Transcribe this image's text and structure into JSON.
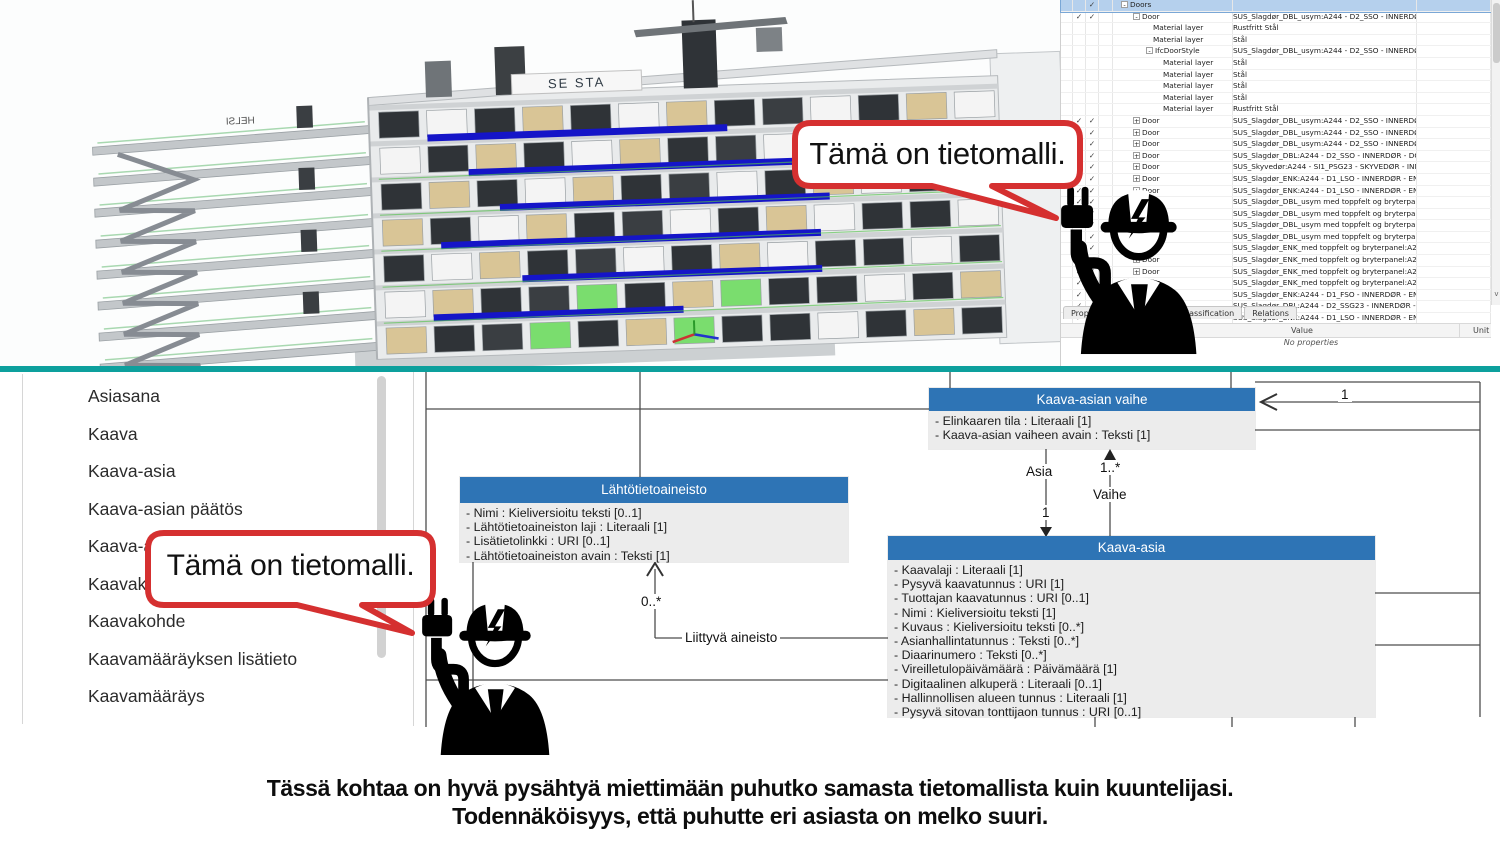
{
  "colors": {
    "accent_blue": "#2e74b5",
    "teal": "#0da09d",
    "bubble_red": "#d53030",
    "selection_blue": "#b5d0ed"
  },
  "bubble": {
    "text": "Tämä on tietomalli."
  },
  "bim_view": {
    "roof_sign": "HELSI",
    "top_sign": "SE STA"
  },
  "top_panel": {
    "tabs": [
      "Properties",
      "Location",
      "Classification",
      "Relations"
    ],
    "value_header": "Value",
    "unit_header": "Unit",
    "empty_text": "No properties",
    "rows": [
      {
        "name": "Doors",
        "value": "",
        "glyph": "-",
        "pad": 8,
        "checks": [
          2
        ],
        "selected": true
      },
      {
        "name": "Door",
        "value": "SUS_Slagdør_DBL_usym:A244 - D2_SSO - INNERDØR  - DO...",
        "glyph": "-",
        "pad": 20,
        "checks": [
          1,
          2
        ]
      },
      {
        "name": "Material layer",
        "value": "Rustfritt Stål",
        "pad": 40,
        "checks": []
      },
      {
        "name": "Material layer",
        "value": "Stål",
        "pad": 40,
        "checks": []
      },
      {
        "name": "IfcDoorStyle",
        "value": "SUS_Slagdør_DBL_usym:A244 - D2_SSO - INNERDØR  - DO...",
        "glyph": "-",
        "pad": 33,
        "checks": []
      },
      {
        "name": "Material layer",
        "value": "Stål",
        "pad": 50,
        "checks": []
      },
      {
        "name": "Material layer",
        "value": "Stål",
        "pad": 50,
        "checks": []
      },
      {
        "name": "Material layer",
        "value": "Stål",
        "pad": 50,
        "checks": []
      },
      {
        "name": "Material layer",
        "value": "Stål",
        "pad": 50,
        "checks": []
      },
      {
        "name": "Material layer",
        "value": "Rustfritt Stål",
        "pad": 50,
        "checks": []
      },
      {
        "name": "Door",
        "value": "SUS_Slagdør_DBL_usym:A244 - D2_SSO - INNERDØR  - DO...",
        "glyph": "+",
        "pad": 20,
        "checks": [
          1,
          2
        ]
      },
      {
        "name": "Door",
        "value": "SUS_Slagdør_DBL_usym:A244 - D2_SSO - INNERDØR  - DO...",
        "glyph": "+",
        "pad": 20,
        "checks": [
          1,
          2
        ]
      },
      {
        "name": "Door",
        "value": "SUS_Slagdør_DBL_usym:A244 - D2_SSO - INNERDØR  - DO...",
        "glyph": "+",
        "pad": 20,
        "checks": [
          1,
          2
        ]
      },
      {
        "name": "Door",
        "value": "SUS_Slagdør_DBL:A244 - D2_SSO - INNERDØR - DOBBEL - ...",
        "glyph": "+",
        "pad": 20,
        "checks": [
          1,
          2
        ]
      },
      {
        "name": "Door",
        "value": "SUS_Skyvedør:A244 - SI1_PSG23 - SKYVEDØR - INNERDØR...",
        "glyph": "+",
        "pad": 20,
        "checks": [
          1,
          2
        ]
      },
      {
        "name": "Door",
        "value": "SUS_Slagdør_ENK:A244 - D1_LSO - INNERDØR  - ENKEL - 1...",
        "glyph": "+",
        "pad": 20,
        "checks": [
          1,
          2
        ]
      },
      {
        "name": "Door",
        "value": "SUS_Slagdør_ENK:A244 - D1_LSO - INNERDØR  - ENKEL - 1...",
        "glyph": "+",
        "pad": 20,
        "checks": [
          1,
          2
        ]
      },
      {
        "name": "Door",
        "value": "SUS_Slagdør_DBL_usym med toppfelt og bryterpanel:A244 ...",
        "glyph": "+",
        "pad": 20,
        "checks": [
          1,
          2
        ]
      },
      {
        "name": "Door",
        "value": "SUS_Slagdør_DBL_usym med toppfelt og bryterpanel:A244 ...",
        "glyph": "+",
        "pad": 20,
        "checks": [
          1,
          2
        ]
      },
      {
        "name": "Door",
        "value": "SUS_Slagdør_DBL_usym med toppfelt og bryterpanel:A244 ...",
        "glyph": "+",
        "pad": 20,
        "checks": [
          1,
          2
        ]
      },
      {
        "name": "Door",
        "value": "SUS_Slagdør_DBL_usym med toppfelt og bryterpanel:A244 ...",
        "glyph": "+",
        "pad": 20,
        "checks": [
          1,
          2
        ]
      },
      {
        "name": "Door",
        "value": "SUS_Slagdør_ENK_med toppfelt og bryterpanel:A244 - D1_...",
        "glyph": "+",
        "pad": 20,
        "checks": [
          1,
          2
        ]
      },
      {
        "name": "Door",
        "value": "SUS_Slagdør_ENK_med toppfelt og bryterpanel:A244 - D1_...",
        "glyph": "+",
        "pad": 20,
        "checks": [
          1,
          2
        ]
      },
      {
        "name": "Door",
        "value": "SUS_Slagdør_ENK_med toppfelt og bryterpanel:A244 - D1_...",
        "glyph": "+",
        "pad": 20,
        "checks": [
          1,
          2
        ]
      },
      {
        "name": "Door",
        "value": "SUS_Slagdør_ENK_med toppfelt og bryterpanel:A244 - D1_...",
        "glyph": "+",
        "pad": 20,
        "checks": [
          1,
          2
        ]
      },
      {
        "name": "Door",
        "value": "SUS_Slagdør_ENK:A244 - D1_FSO - INNERDØR  - ENKEL - B...",
        "glyph": "+",
        "pad": 20,
        "checks": [
          1,
          2
        ]
      },
      {
        "name": "Door",
        "value": "SUS_Slagdør_DBL:A244 - D2_SSG23 - INNERDØR - DOBBEL...",
        "glyph": "+",
        "pad": 20,
        "checks": [
          1,
          2
        ]
      },
      {
        "name": "Door",
        "value": "SUS_Slagdør_ENK:A244 - D1_LSO - INNERDØR - ENKEL - 1...",
        "glyph": "+",
        "pad": 20,
        "checks": [
          1,
          2
        ]
      }
    ]
  },
  "sidebar": {
    "items": [
      "Asiasana",
      "Kaava",
      "Kaava-asia",
      "Kaava-asian päätös",
      "Kaava-asian vaihe",
      "Kaavakartta",
      "Kaavakohde",
      "Kaavamääräyksen lisätieto",
      "Kaavamääräys"
    ]
  },
  "uml": {
    "vaihe": {
      "title": "Kaava-asian vaihe",
      "attrs": [
        "- Elinkaaren tila : Literaali [1]",
        "- Kaava-asian vaiheen avain : Teksti [1]"
      ]
    },
    "lahtotieto": {
      "title": "Lähtötietoaineisto",
      "attrs": [
        "- Nimi : Kieliversioitu teksti [0..1]",
        "- Lähtötietoaineiston laji : Literaali [1]",
        "- Lisätietolinkki : URI [0..1]",
        "- Lähtötietoaineiston avain : Teksti [1]"
      ]
    },
    "kaava_asia": {
      "title": "Kaava-asia",
      "attrs": [
        "- Kaavalaji : Literaali [1]",
        "- Pysyvä kaavatunnus : URI [1]",
        "- Tuottajan kaavatunnus : URI [0..1]",
        "- Nimi : Kieliversioitu teksti [1]",
        "- Kuvaus : Kieliversioitu teksti [0..*]",
        "- Asianhallintatunnus : Teksti [0..*]",
        "- Diaarinumero : Teksti [0..*]",
        "- Vireilletulopäivämäärä : Päivämäärä [1]",
        "- Digitaalinen alkuperä : Literaali [0..1]",
        "- Hallinnollisen alueen tunnus : Literaali [1]",
        "- Pysyvä sitovan tonttijaon tunnus : URI [0..1]"
      ]
    }
  },
  "diagram_labels": {
    "asia": "Asia",
    "asia_card": "1",
    "vaihe": "Vaihe",
    "vaihe_card": "1..*",
    "liittyva_card": "0..*",
    "liittyva": "Liittyvä aineisto",
    "right_card": "1"
  },
  "caption": {
    "line1": "Tässä kohtaa on hyvä pysähtyä miettimään puhutko samasta tietomallista kuin kuuntelijasi.",
    "line2": "Todennäköisyys, että puhutte eri asiasta on melko suuri."
  }
}
